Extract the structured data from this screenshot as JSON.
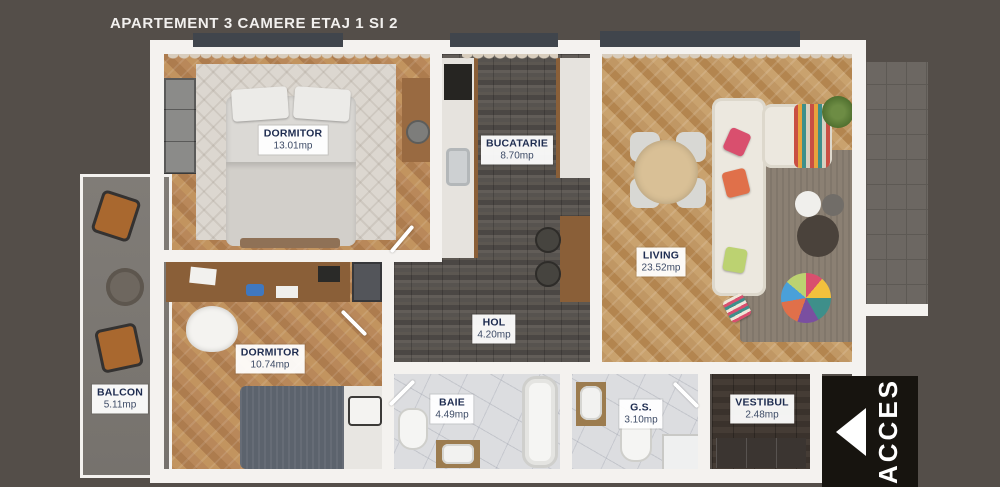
{
  "title": "APARTEMENT 3 CAMERE ETAJ 1 SI 2",
  "access": {
    "label": "ACCES"
  },
  "rooms": [
    {
      "name": "DORMITOR",
      "area": "13.01mp"
    },
    {
      "name": "BUCATARIE",
      "area": "8.70mp"
    },
    {
      "name": "LIVING",
      "area": "23.52mp"
    },
    {
      "name": "DORMITOR",
      "area": "10.74mp"
    },
    {
      "name": "HOL",
      "area": "4.20mp"
    },
    {
      "name": "BAIE",
      "area": "4.49mp"
    },
    {
      "name": "G.S.",
      "area": "3.10mp"
    },
    {
      "name": "VESTIBUL",
      "area": "2.48mp"
    },
    {
      "name": "BALCON",
      "area": "5.11mp"
    }
  ],
  "colors": {
    "background": "#544e49",
    "wall": "#f4f2ef",
    "label_text": "#1e2c50",
    "acces_background": "#17140f",
    "wood_floor": "#b9885a",
    "stone_floor": "#57534f",
    "marble_floor": "#dcdde0",
    "balcony_floor": "#7b7772"
  }
}
